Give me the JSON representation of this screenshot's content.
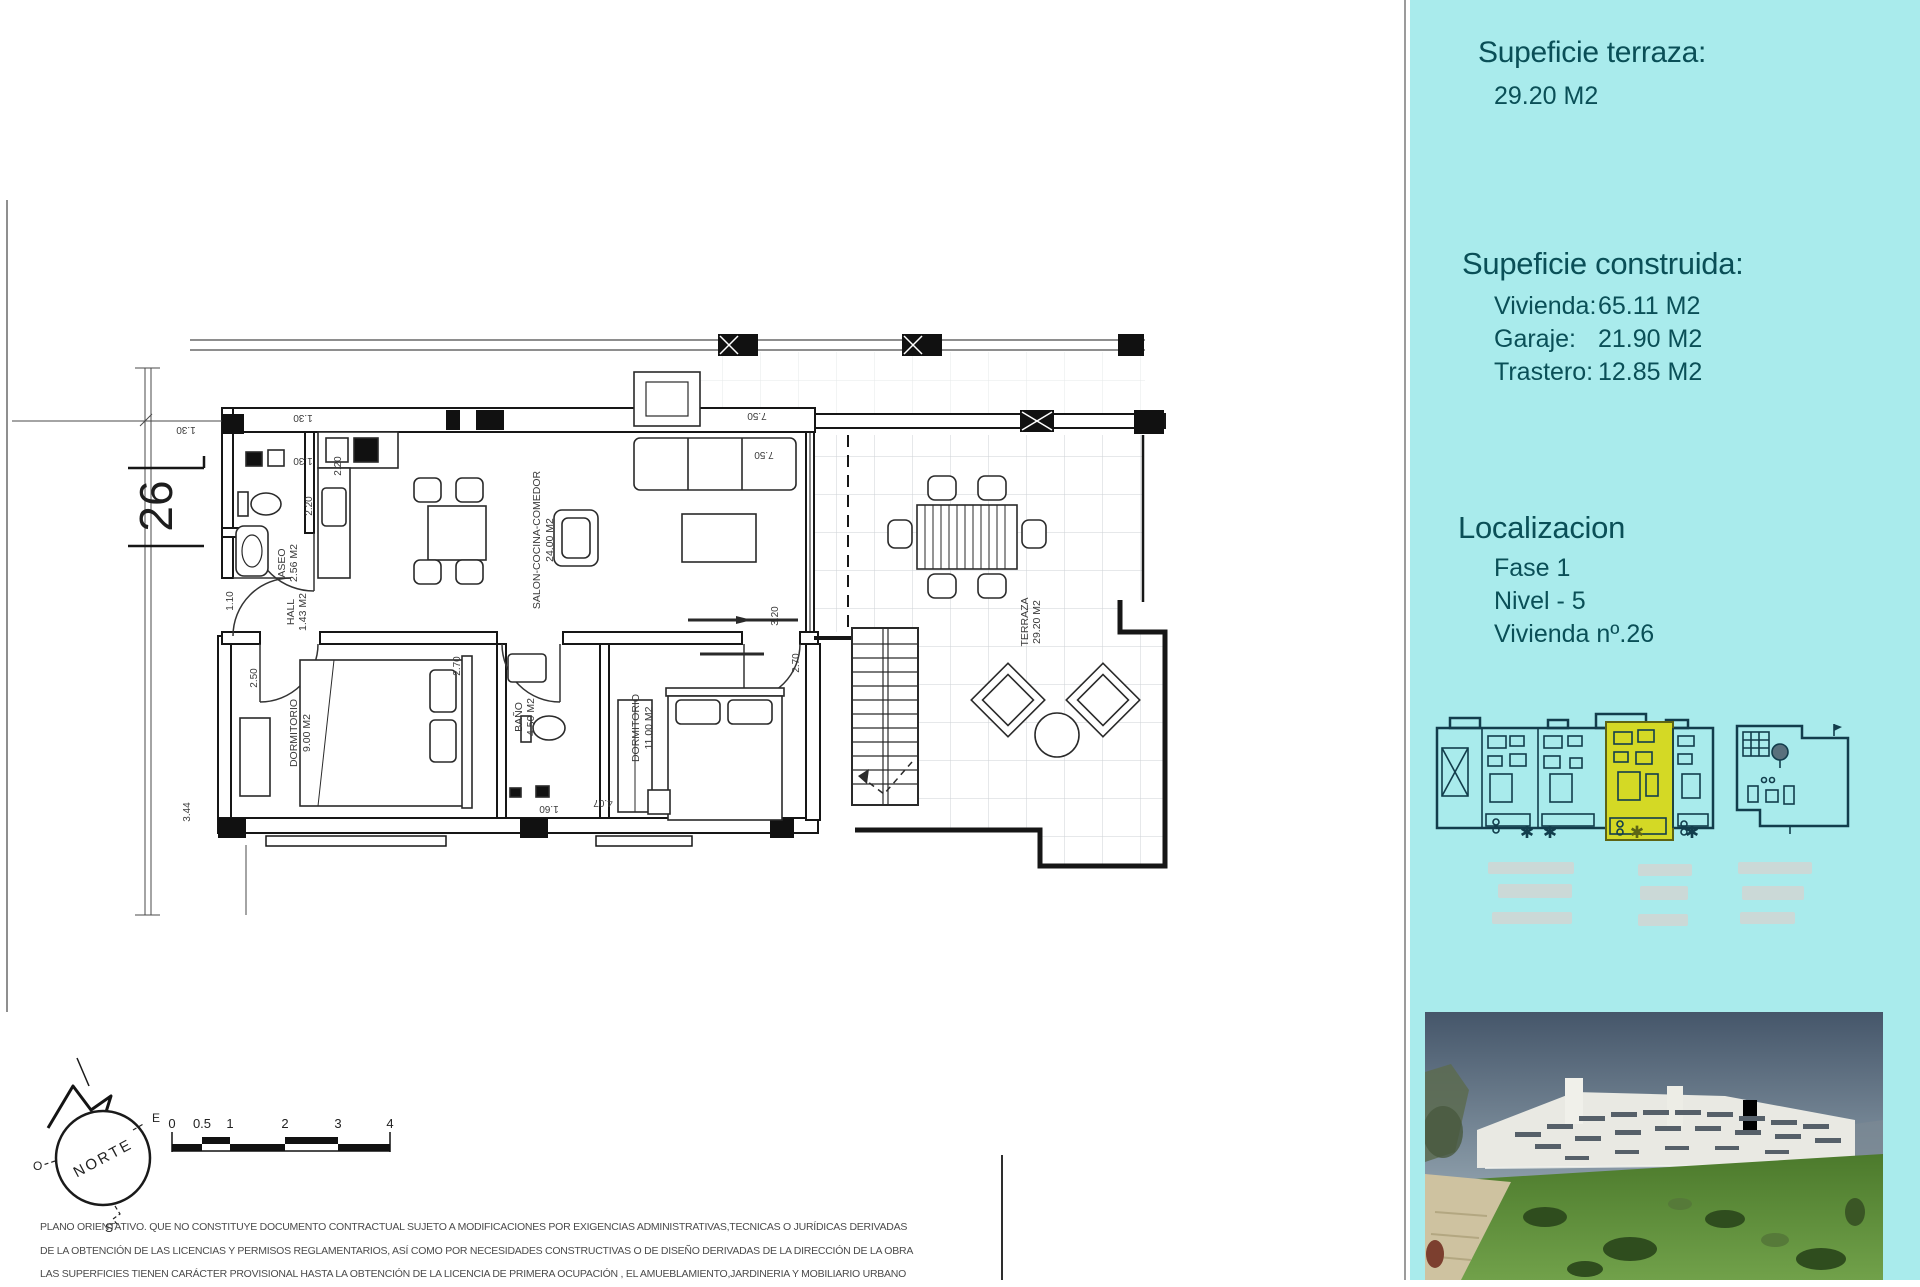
{
  "plan": {
    "unit_number": "26",
    "rooms": [
      {
        "name": "ASEO",
        "area": "2.56 M2"
      },
      {
        "name": "HALL",
        "area": "1.43 M2"
      },
      {
        "name": "SALON-COCINA-COMEDOR",
        "area": "24.00 M2"
      },
      {
        "name": "DORMITORIO",
        "area": "9.00 M2"
      },
      {
        "name": "BAÑO",
        "area": "4.50 M2"
      },
      {
        "name": "DORMITORIO",
        "area": "11.00 M2"
      },
      {
        "name": "TERRAZA",
        "area": "29.20 M2"
      }
    ],
    "dims": [
      "1.30",
      "1.30",
      "1.30",
      "2.20",
      "2.20",
      "1.10",
      "2.50",
      "3.44",
      "2.70",
      "2.70",
      "1.60",
      "4.07",
      "7.50",
      "7.50",
      "3.20"
    ],
    "compass": {
      "north": "NORTE",
      "east": "E",
      "west": "O",
      "south": "S"
    },
    "scale_ticks": [
      "0",
      "0.5",
      "1",
      "2",
      "3",
      "4"
    ]
  },
  "sidebar": {
    "background": "#a9ebec",
    "text_color": "#0a4f57",
    "highlight_color": "#d4d925",
    "terrace_title": "Supeficie terraza:",
    "terrace_value": "29.20 M2",
    "built_title": "Supeficie construida:",
    "built_rows": [
      {
        "label": "Vivienda:",
        "value": "65.11 M2"
      },
      {
        "label": "Garaje:",
        "value": "21.90 M2"
      },
      {
        "label": "Trastero:",
        "value": "12.85 M2"
      }
    ],
    "location_title": "Localizacion",
    "location_rows": [
      "Fase 1",
      "Nivel - 5",
      "Vivienda nº.26"
    ]
  },
  "disclaimer": {
    "lines": [
      "PLANO ORIENTATIVO. QUE NO CONSTITUYE DOCUMENTO CONTRACTUAL SUJETO A MODIFICACIONES POR EXIGENCIAS ADMINISTRATIVAS,TECNICAS O JURÍDICAS DERIVADAS",
      "DE LA OBTENCIÓN DE LAS LICENCIAS Y PERMISOS REGLAMENTARIOS, ASÍ COMO POR NECESIDADES CONSTRUCTIVAS  O DE DISEÑO DERIVADAS DE LA DIRECCIÓN DE LA OBRA",
      "LAS SUPERFICIES TIENEN CARÁCTER PROVISIONAL HASTA LA OBTENCIÓN DE LA LICENCIA DE PRIMERA OCUPACIÓN , EL AMUEBLAMIENTO,JARDINERIA Y MOBILIARIO URBANO"
    ]
  }
}
